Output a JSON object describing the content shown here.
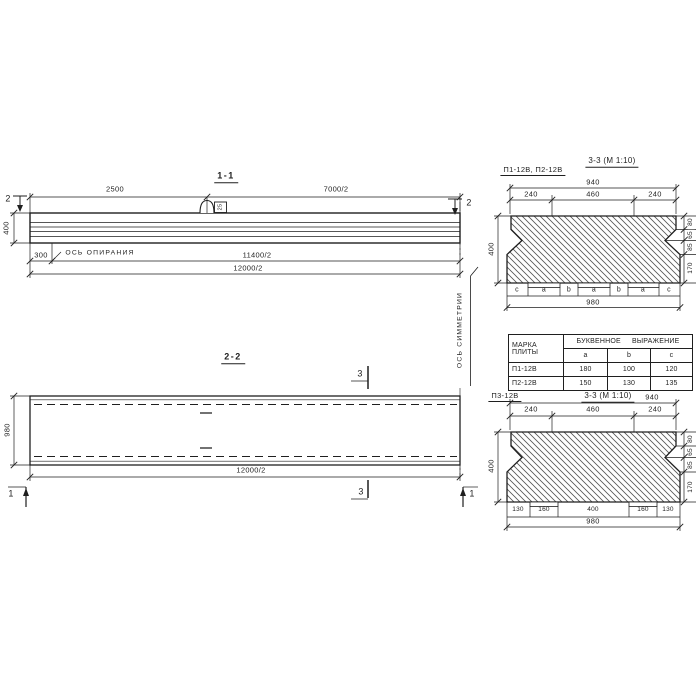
{
  "section_1_1": {
    "title": "1-1",
    "cut_marker": "2",
    "support_axis_label": "ось опирания",
    "loop_tag": "25",
    "dims": {
      "top_left": "2500",
      "top_right": "7000/2",
      "height": "400",
      "support_offset": "300",
      "half_len_support": "11400/2",
      "half_len_total": "12000/2"
    }
  },
  "symmetry_axis_label": "ось симметрии",
  "section_2_2": {
    "title": "2-2",
    "cut_marker_3": "3",
    "cut_marker_1": "1",
    "dims": {
      "width": "980",
      "half_len": "12000/2"
    }
  },
  "section_3_3_top": {
    "label": "П1-12В, П2-12В",
    "title": "3-3",
    "scale": "(М 1:10)",
    "dims": {
      "top_total": "940",
      "chain_top": [
        "240",
        "460",
        "240"
      ],
      "height": "400",
      "chain_right": [
        "80",
        "65",
        "85",
        "170"
      ],
      "letters": [
        "c",
        "a",
        "b",
        "a",
        "b",
        "a",
        "c"
      ],
      "bottom_total": "980"
    }
  },
  "table": {
    "header_mark_line1": "МАРКА",
    "header_mark_line2": "ПЛИТЫ",
    "header_expr": "БУКВЕННОЕ ВЫРАЖЕНИЕ",
    "col_headers": [
      "a",
      "b",
      "c"
    ],
    "rows": [
      {
        "mark": "П1-12В",
        "a": "180",
        "b": "100",
        "c": "120"
      },
      {
        "mark": "П2-12В",
        "a": "150",
        "b": "130",
        "c": "135"
      }
    ]
  },
  "section_3_3_bottom": {
    "label": "П3-12В",
    "title": "3-3",
    "scale": "(М 1:10)",
    "dims": {
      "top_total": "940",
      "chain_top": [
        "240",
        "460",
        "240"
      ],
      "height": "400",
      "chain_right": [
        "80",
        "65",
        "85",
        "170"
      ],
      "chain_bottom": [
        "130",
        "160",
        "400",
        "160",
        "130"
      ],
      "bottom_total": "980"
    }
  }
}
